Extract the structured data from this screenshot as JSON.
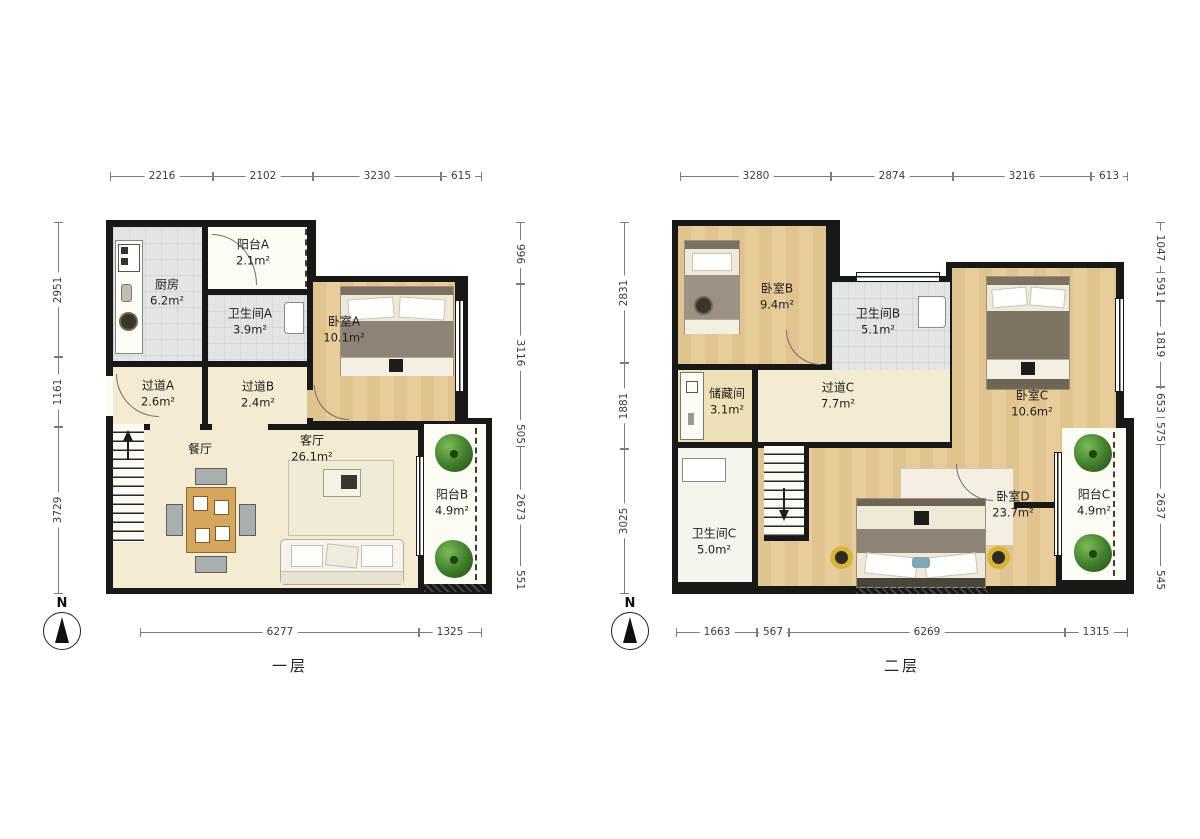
{
  "floor1": {
    "caption": "一层",
    "compass": "N",
    "dims": {
      "top": [
        "2216",
        "2102",
        "3230",
        "615"
      ],
      "left": [
        "2951",
        "1161",
        "3729"
      ],
      "right": [
        "996",
        "3116",
        "505",
        "2673",
        "551"
      ],
      "bottom": [
        "6277",
        "1325"
      ]
    },
    "rooms": {
      "kitchen": {
        "name": "厨房",
        "area": "6.2m²"
      },
      "balcony_a": {
        "name": "阳台A",
        "area": "2.1m²"
      },
      "bathroom_a": {
        "name": "卫生间A",
        "area": "3.9m²"
      },
      "bedroom_a": {
        "name": "卧室A",
        "area": "10.1m²"
      },
      "hallway_a": {
        "name": "过道A",
        "area": "2.6m²"
      },
      "hallway_b": {
        "name": "过道B",
        "area": "2.4m²"
      },
      "dining": {
        "name": "餐厅",
        "area": ""
      },
      "living": {
        "name": "客厅",
        "area": "26.1m²"
      },
      "balcony_b": {
        "name": "阳台B",
        "area": "4.9m²"
      }
    }
  },
  "floor2": {
    "caption": "二层",
    "compass": "N",
    "dims": {
      "top": [
        "3280",
        "2874",
        "3216",
        "613"
      ],
      "left": [
        "2831",
        "1881",
        "3025"
      ],
      "right": [
        "1047",
        "591",
        "1819",
        "653",
        "575",
        "2637",
        "545"
      ],
      "bottom": [
        "1663",
        "567",
        "6269",
        "1315"
      ]
    },
    "rooms": {
      "bedroom_b": {
        "name": "卧室B",
        "area": "9.4m²"
      },
      "bathroom_b": {
        "name": "卫生间B",
        "area": "5.1m²"
      },
      "bedroom_c": {
        "name": "卧室C",
        "area": "10.6m²"
      },
      "storage": {
        "name": "储藏间",
        "area": "3.1m²"
      },
      "hallway_c": {
        "name": "过道C",
        "area": "7.7m²"
      },
      "bathroom_c": {
        "name": "卫生间C",
        "area": "5.0m²"
      },
      "bedroom_d": {
        "name": "卧室D",
        "area": "23.7m²"
      },
      "balcony_c": {
        "name": "阳台C",
        "area": "4.9m²"
      }
    }
  },
  "colors": {
    "wall": "#181818",
    "wood_floor": "#e8cd9b",
    "corridor_floor": "#f4ecd2",
    "tile_floor": "#e1e5e4",
    "balcony_floor": "#fcfbf4",
    "plant_green": "#3e7c2b",
    "dimension_line": "#7c7c7c"
  }
}
